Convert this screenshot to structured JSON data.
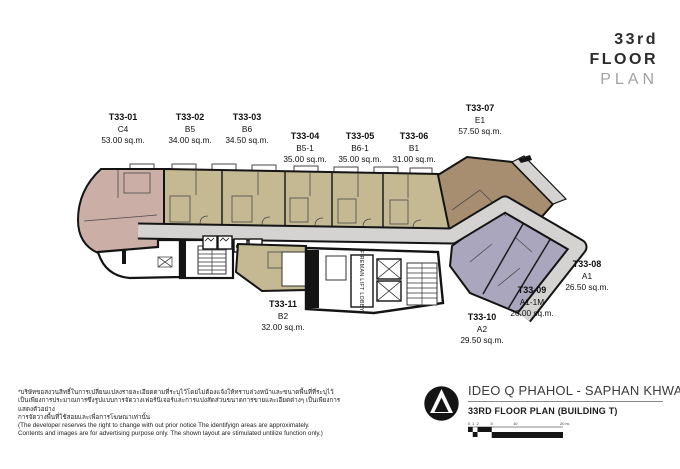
{
  "header": {
    "floor_number": "33rd",
    "floor_word": "FLOOR",
    "plan_word": "PLAN"
  },
  "plan": {
    "units": [
      {
        "id": "T33-01",
        "type": "C4",
        "area": "53.00 sq.m."
      },
      {
        "id": "T33-02",
        "type": "B5",
        "area": "34.00 sq.m."
      },
      {
        "id": "T33-03",
        "type": "B6",
        "area": "34.50 sq.m."
      },
      {
        "id": "T33-04",
        "type": "B5-1",
        "area": "35.00 sq.m."
      },
      {
        "id": "T33-05",
        "type": "B6-1",
        "area": "35.00 sq.m."
      },
      {
        "id": "T33-06",
        "type": "B1",
        "area": "31.00 sq.m."
      },
      {
        "id": "T33-07",
        "type": "E1",
        "area": "57.50 sq.m."
      },
      {
        "id": "T33-08",
        "type": "A1",
        "area": "26.50 sq.m."
      },
      {
        "id": "T33-09",
        "type": "A1-1M",
        "area": "26.00 sq.m."
      },
      {
        "id": "T33-10",
        "type": "A2",
        "area": "29.50 sq.m."
      },
      {
        "id": "T33-11",
        "type": "B2",
        "area": "32.00 sq.m."
      }
    ],
    "core_labels": {
      "fireman_lobby": "FIREMAN LIFT LOBBY",
      "gb": "GB",
      "sn": "SN"
    }
  },
  "disclaimer": {
    "thai": [
      "*บริษัทขอสงวนสิทธิ์ในการเปลี่ยนแปลงรายละเอียดตามที่ระบุไว้โดยไม่ต้องแจ้งให้ทราบล่วงหน้าและขนาดพื้นที่ที่ระบุไว้",
      "เป็นเพียงการประมาณการซึ่งรูปแบบการจัดวางเฟอร์นิเจอร์และการแบ่งสัดส่วนขนาดการขายและเอียดต่างๆ เป็นเพียงการแสดงตัวอย่าง",
      "การจัดวางพื้นที่ใช้สอยและเพื่อการโฆษณาเท่านั้น"
    ],
    "english": [
      "(The  developer reserves the right to change with out prior notice The identifyign areas are approximately.",
      "Contents and images are for advertising purpose only. The shown layout are stimulated untilize function only.)"
    ]
  },
  "footer": {
    "project_name": "IDEO Q PHAHOL - SAPHAN KHWAI",
    "plan_title": "33RD FLOOR PLAN (BUILDING T)",
    "scale_labels": [
      "0",
      "1",
      "2",
      "5",
      "10",
      "20 m."
    ]
  },
  "colors": {
    "unit_c4_pink": "#cbaea6",
    "unit_b_tan": "#c4b993",
    "unit_e1_brown": "#a78e70",
    "unit_a_lavender": "#a9a6be",
    "corridor_gray": "#d4d3d1",
    "wall_black": "#141414"
  }
}
